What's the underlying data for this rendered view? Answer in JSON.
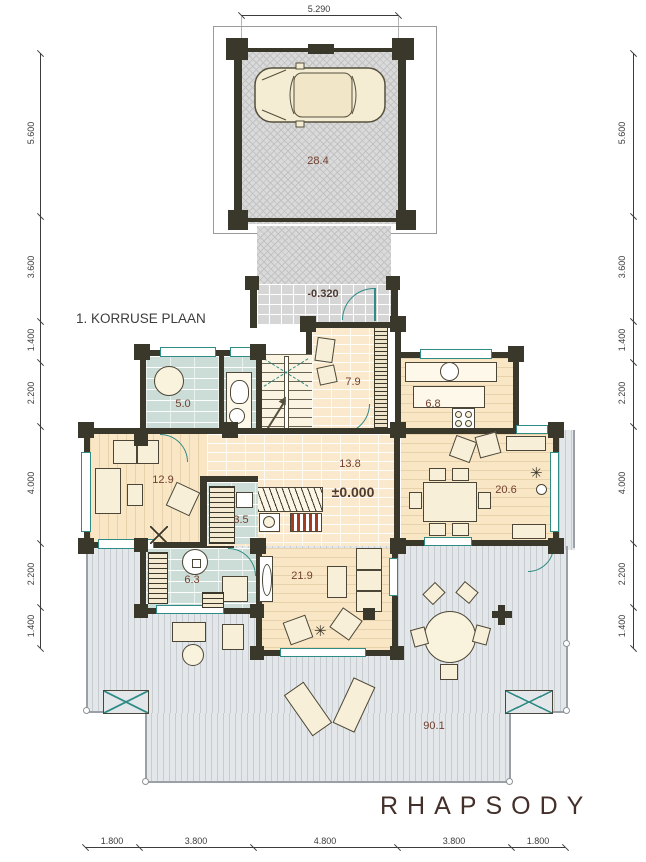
{
  "plan": {
    "title": "1. KORRUSE PLAAN",
    "project": "RHAPSODY"
  },
  "levels": {
    "porch": "-0.320",
    "ground": "±0.000"
  },
  "rooms": {
    "garage": "28.4",
    "bathroom": "5.0",
    "stair_hall": "7.9",
    "kitchen": "6.8",
    "room_left": "12.9",
    "hall": "13.8",
    "sauna": "3.5",
    "washroom": "6.3",
    "living": "21.9",
    "dining": "20.6",
    "terrace": "90.1"
  },
  "dimensions": {
    "top": [
      "5.290"
    ],
    "bottom": [
      "1.800",
      "3.800",
      "4.800",
      "3.800",
      "1.800"
    ],
    "left": [
      "5.600",
      "3.600",
      "1.400",
      "2.200",
      "4.000",
      "2.200",
      "1.400"
    ],
    "right": [
      "5.600",
      "3.600",
      "1.400",
      "2.200",
      "4.000",
      "2.200",
      "1.400"
    ]
  },
  "colors": {
    "wall": "#3a372b",
    "window_frame": "#2f8b85",
    "wood_floor": "#f8e6c5",
    "tile_blue": "#ccdcd6",
    "terrace_deck": "#e4e7ea",
    "room_label": "#713f2e"
  }
}
